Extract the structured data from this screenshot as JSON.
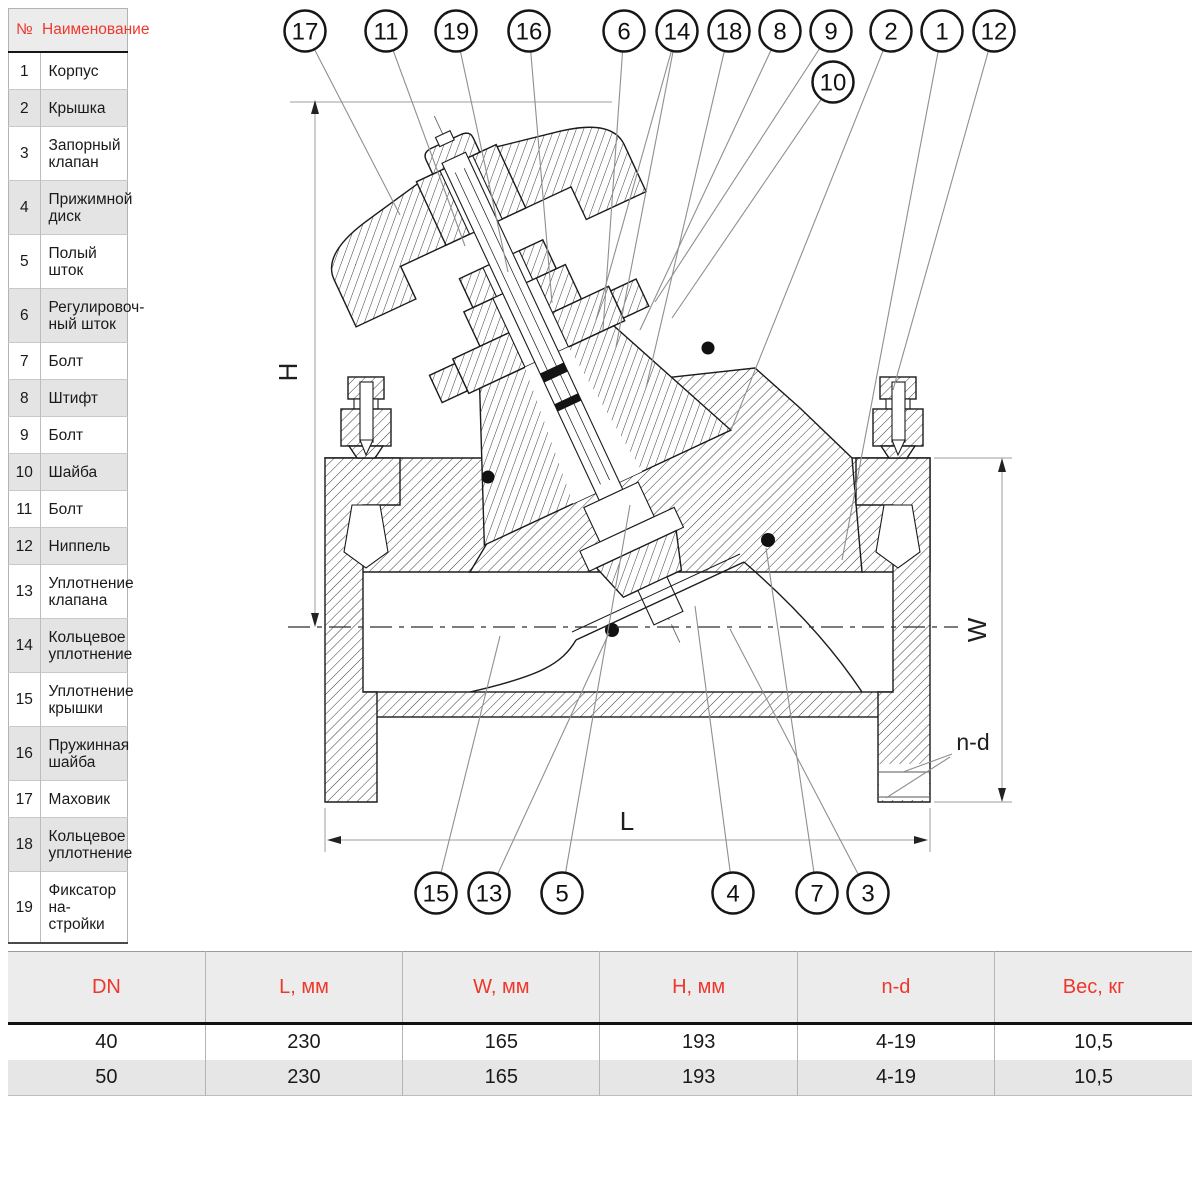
{
  "colors": {
    "accent_red": "#ee382b",
    "table_row_shade": "#e4e4e4",
    "table_header_bg": "#ececec",
    "drawing_line": "#1b1b1b",
    "leader_line": "#8f8f8f",
    "dimension_line": "#9c9c9c"
  },
  "parts_table": {
    "headers": {
      "num": "№",
      "name": "Наименование"
    },
    "rows": [
      {
        "num": "1",
        "name": "Корпус"
      },
      {
        "num": "2",
        "name": "Крышка"
      },
      {
        "num": "3",
        "name": "Запорный\nклапан"
      },
      {
        "num": "4",
        "name": "Прижимной\nдиск"
      },
      {
        "num": "5",
        "name": "Полый шток"
      },
      {
        "num": "6",
        "name": "Регулировоч-\nный шток"
      },
      {
        "num": "7",
        "name": "Болт"
      },
      {
        "num": "8",
        "name": "Штифт"
      },
      {
        "num": "9",
        "name": "Болт"
      },
      {
        "num": "10",
        "name": "Шайба"
      },
      {
        "num": "11",
        "name": "Болт"
      },
      {
        "num": "12",
        "name": "Ниппель"
      },
      {
        "num": "13",
        "name": "Уплотнение\nклапана"
      },
      {
        "num": "14",
        "name": "Кольцевое\nуплотнение"
      },
      {
        "num": "15",
        "name": "Уплотнение\nкрышки"
      },
      {
        "num": "16",
        "name": "Пружинная\nшайба"
      },
      {
        "num": "17",
        "name": "Маховик"
      },
      {
        "num": "18",
        "name": "Кольцевое\nуплотнение"
      },
      {
        "num": "19",
        "name": "Фиксатор на-\nстройки"
      }
    ]
  },
  "dimensions_table": {
    "headers": [
      "DN",
      "L, мм",
      "W, мм",
      "H, мм",
      "n-d",
      "Вес, кг"
    ],
    "rows": [
      [
        "40",
        "230",
        "165",
        "193",
        "4-19",
        "10,5"
      ],
      [
        "50",
        "230",
        "165",
        "193",
        "4-19",
        "10,5"
      ]
    ]
  },
  "drawing": {
    "labels": {
      "height": "H",
      "length": "L",
      "width": "W",
      "bolt_holes": "n-d"
    },
    "callouts": [
      {
        "label": "17",
        "cx": 305,
        "cy": 31,
        "tx": 400,
        "ty": 215
      },
      {
        "label": "11",
        "cx": 386,
        "cy": 31,
        "tx": 465,
        "ty": 246
      },
      {
        "label": "19",
        "cx": 456,
        "cy": 31,
        "tx": 508,
        "ty": 272
      },
      {
        "label": "16",
        "cx": 529,
        "cy": 31,
        "tx": 552,
        "ty": 303
      },
      {
        "label": "6",
        "cx": 624,
        "cy": 31,
        "tx": 603,
        "ty": 330
      },
      {
        "label": "14",
        "cx": 677,
        "cy": 31,
        "tx": 596,
        "ty": 320,
        "tx2": 616,
        "ty2": 347
      },
      {
        "label": "18",
        "cx": 729,
        "cy": 31,
        "tx": 646,
        "ty": 388
      },
      {
        "label": "8",
        "cx": 780,
        "cy": 31,
        "tx": 640,
        "ty": 330
      },
      {
        "label": "9",
        "cx": 831,
        "cy": 31,
        "tx": 655,
        "ty": 302
      },
      {
        "label": "10",
        "cx": 833,
        "cy": 82,
        "tx": 672,
        "ty": 318
      },
      {
        "label": "2",
        "cx": 891,
        "cy": 31,
        "tx": 731,
        "ty": 430
      },
      {
        "label": "1",
        "cx": 942,
        "cy": 31,
        "tx": 842,
        "ty": 560
      },
      {
        "label": "12",
        "cx": 994,
        "cy": 31,
        "tx": 893,
        "ty": 390
      },
      {
        "label": "15",
        "cx": 436,
        "cy": 893,
        "tx": 500,
        "ty": 636
      },
      {
        "label": "13",
        "cx": 489,
        "cy": 893,
        "tx": 609,
        "ty": 633
      },
      {
        "label": "5",
        "cx": 562,
        "cy": 893,
        "tx": 630,
        "ty": 505
      },
      {
        "label": "4",
        "cx": 733,
        "cy": 893,
        "tx": 695,
        "ty": 606
      },
      {
        "label": "7",
        "cx": 817,
        "cy": 893,
        "tx": 766,
        "ty": 548
      },
      {
        "label": "3",
        "cx": 868,
        "cy": 893,
        "tx": 730,
        "ty": 629
      }
    ]
  }
}
